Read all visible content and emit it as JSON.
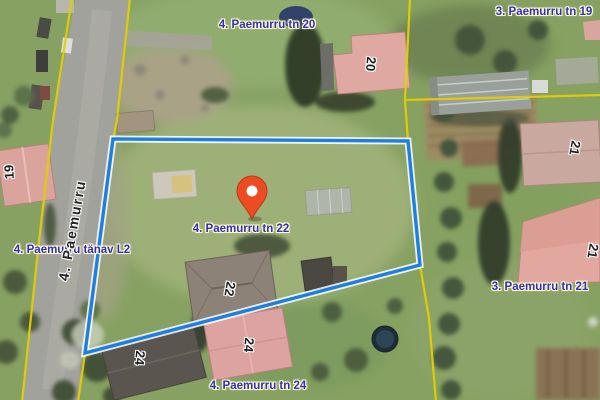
{
  "map": {
    "colors": {
      "selected_parcel_outline": "#1d7fe0",
      "cadastral_boundary": "#e3cf00",
      "marker": "#ee4b23",
      "address_label_text": "#2d2dd2",
      "label_halo": "#fffbc4"
    },
    "address_labels": [
      {
        "text": "4. Paemurru tn 20"
      },
      {
        "text": "3. Paemurru tn 19"
      },
      {
        "text": "4. Paemurru tänav L2"
      },
      {
        "text": "4. Paemurru tn 22"
      },
      {
        "text": "3. Paemurru tn 21"
      },
      {
        "text": "4. Paemurru tn 24"
      }
    ],
    "street_label": {
      "text": "4. Paemurru"
    },
    "building_numbers": [
      {
        "text": "19"
      },
      {
        "text": "20"
      },
      {
        "text": "21"
      },
      {
        "text": "21"
      },
      {
        "text": "22"
      },
      {
        "text": "24"
      },
      {
        "text": "24"
      }
    ],
    "selected_parcel": {
      "address": "4. Paemurru tn 22"
    }
  }
}
